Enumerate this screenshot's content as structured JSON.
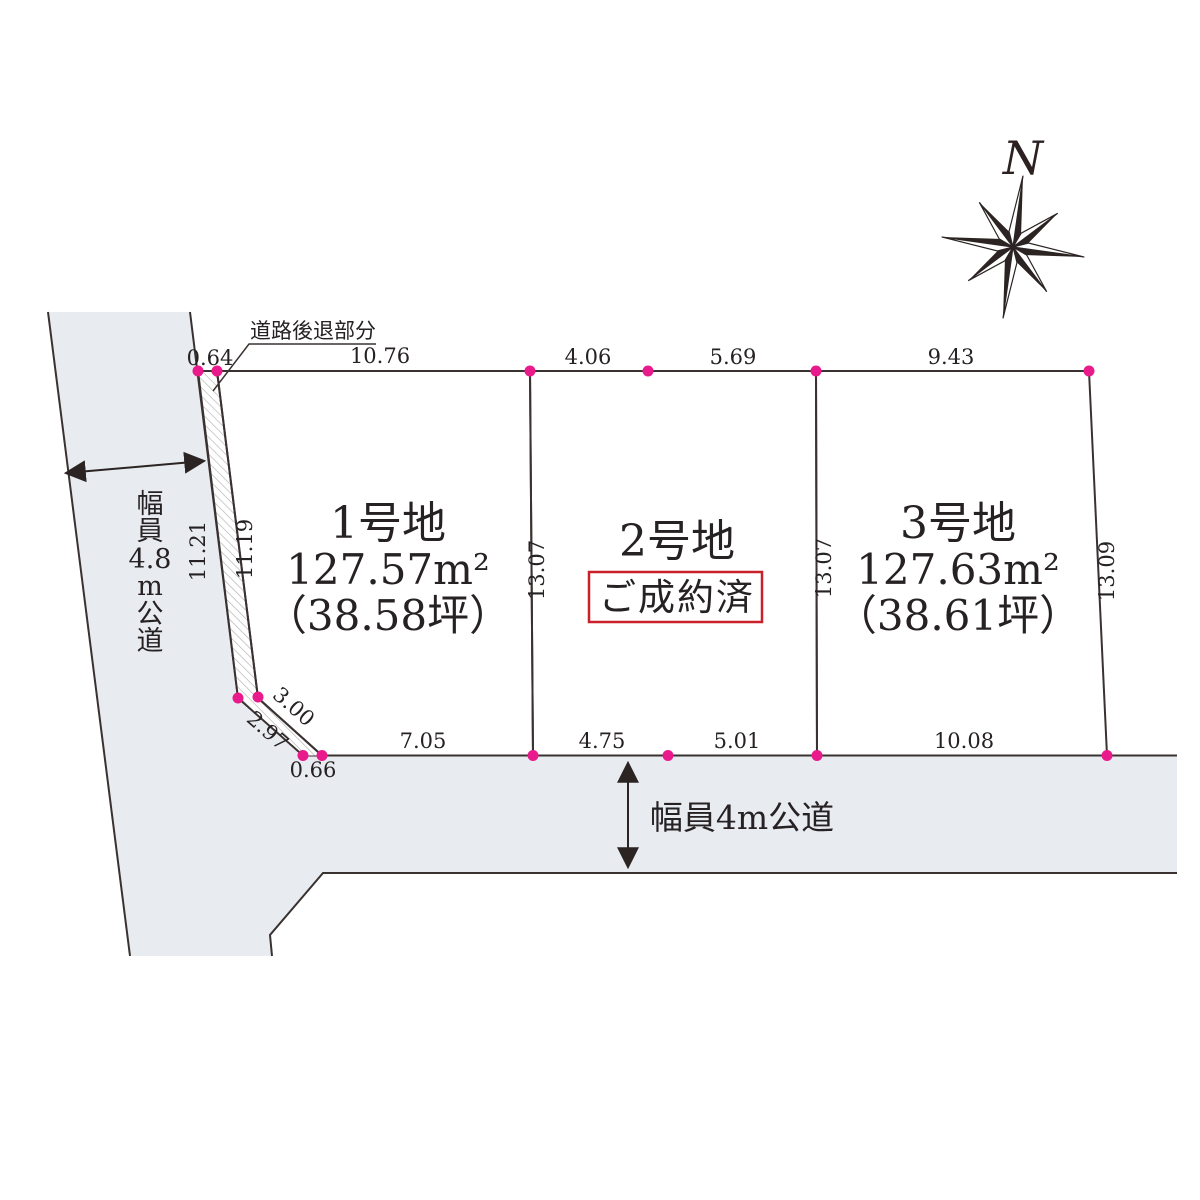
{
  "compass": {
    "label": "N"
  },
  "plots": [
    {
      "name": "1号地",
      "area_m2": "127.57m²",
      "area_tsubo": "（38.58坪）"
    },
    {
      "name": "2号地",
      "status": "ご成約済"
    },
    {
      "name": "3号地",
      "area_m2": "127.63m²",
      "area_tsubo": "（38.61坪）"
    }
  ],
  "roads": {
    "left": {
      "label": "幅員4.8m公道",
      "label_segments": [
        "幅",
        "員",
        "4.8",
        "m",
        "公",
        "道"
      ]
    },
    "bottom": {
      "label": "幅員4m公道"
    }
  },
  "setback": {
    "label": "道路後退部分"
  },
  "dimensions": {
    "top": [
      "0.64",
      "10.76",
      "4.06",
      "5.69",
      "9.43"
    ],
    "bottom": [
      "0.66",
      "7.05",
      "4.75",
      "5.01",
      "10.08"
    ],
    "left_outer": "11.21",
    "left_inner": "11.19",
    "boundary_plot1_plot2": "13.07",
    "boundary_plot2_plot3": "13.07",
    "right_edge": "13.09",
    "diagonal_outer": "2.97",
    "diagonal_inner": "3.00"
  },
  "colors": {
    "plot_green": "#edf3ea",
    "plot_white": "#ffffff",
    "road_gray": "#e8ebf0",
    "corner_dot": "#e91a8c",
    "sold_red": "#c9202a",
    "line": "#3a3230",
    "text": "#262123"
  }
}
